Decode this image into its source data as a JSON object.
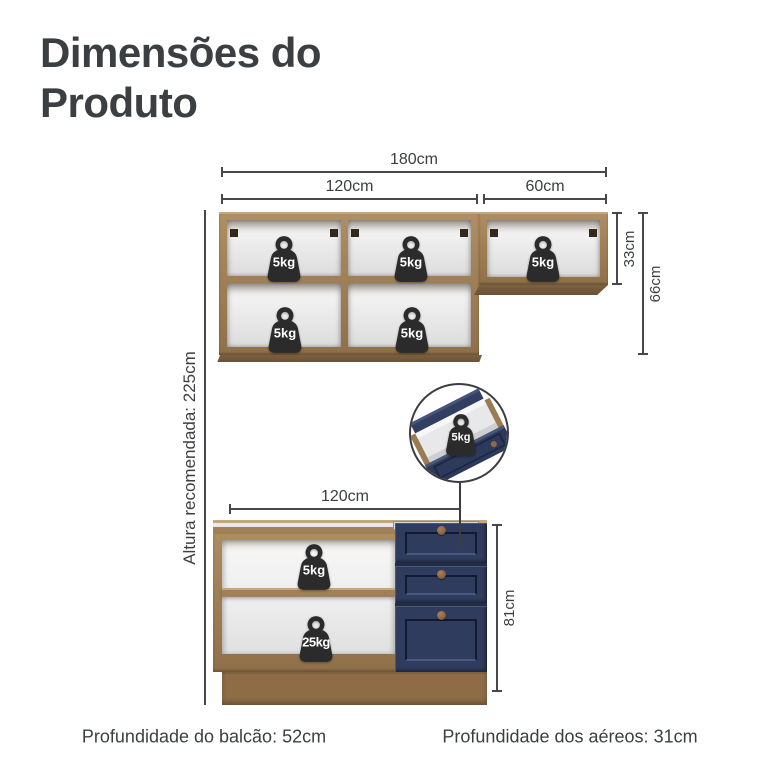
{
  "page": {
    "title_line1": "Dimensões do",
    "title_line2": "Produto"
  },
  "upper_cabinet": {
    "dim_total_width": "180cm",
    "dim_left_width": "120cm",
    "dim_right_width": "60cm",
    "dim_right_height": "33cm",
    "dim_left_height": "66cm",
    "shelf_weights": [
      "5kg",
      "5kg",
      "5kg",
      "5kg",
      "5kg"
    ]
  },
  "wall": {
    "recommended_height": "Altura recomendada: 225cm"
  },
  "drawer_callout": {
    "max_weight": "5kg"
  },
  "base_cabinet": {
    "dim_width": "120cm",
    "dim_height": "81cm",
    "shelf_weight": "5kg",
    "bottom_weight": "25kg"
  },
  "footer": {
    "counter_depth": "Profundidade do balcão: 52cm",
    "aerial_depth": "Profundidade dos aéreos: 31cm"
  },
  "colors": {
    "wood": "#a08157",
    "wood_light": "#c4a87c",
    "wood_dark": "#7c6140",
    "interior": "#f0f0f0",
    "navy": "#2f3c5e",
    "navy_light": "#4a5878",
    "navy_dark": "#222c49",
    "weight": "#2b2b2b",
    "knob": "#8d6747",
    "plinth": "#8d6c46",
    "metal_rim": "#d6d7d8",
    "line": "#46484b",
    "text": "#3c3f41"
  }
}
